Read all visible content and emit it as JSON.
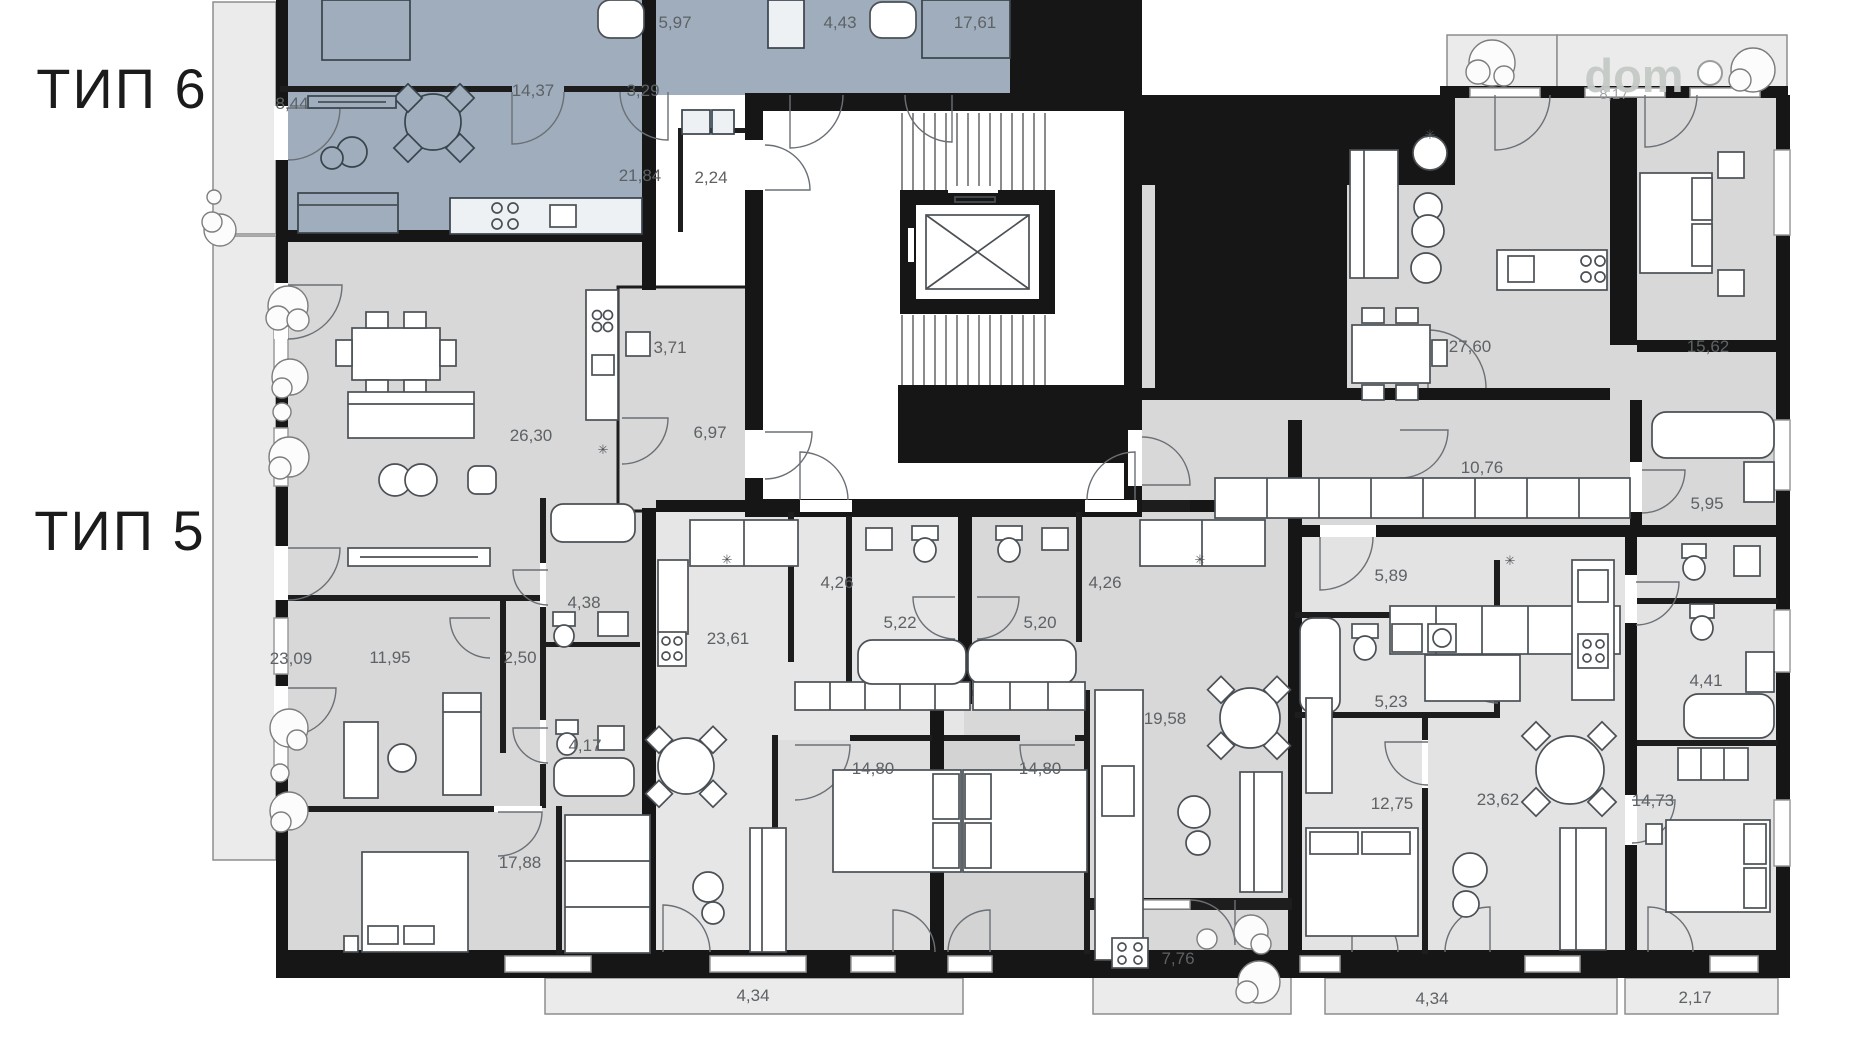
{
  "colors": {
    "type6_fill": "#9fadbc",
    "type6_balcony": "#b6c0ca",
    "room_gray": "#d8d8d8",
    "room_light": "#e6e6e6",
    "balcony_gray": "#ebebeb",
    "wall": "#161616",
    "label_text": "#5d6266",
    "title_text": "#1b1b1b",
    "watermark_gray": "#c6cac6"
  },
  "titles": {
    "type6": "ТИП 6",
    "type5": "ТИП 5"
  },
  "watermark": {
    "brand": "dom",
    "obscured_area": "8,17"
  },
  "symbols": {
    "vent": "✳"
  },
  "apartments": {
    "type6": {
      "name": "Apartment type 6 (highlighted, top left)",
      "areas": {
        "balcony": "8,44",
        "bedroom_a": "14,37",
        "hall_a": "3,29",
        "bathroom": "5,97",
        "hall_b": "4,43",
        "bedroom_b": "17,61",
        "living": "21,84",
        "pantry": "2,24"
      }
    },
    "type5_left": {
      "name": "Apartment type 5 (left)",
      "areas": {
        "balcony": "23,09",
        "living": "26,30",
        "kitchen": "3,71",
        "hall_a": "6,97",
        "bedroom_a": "11,95",
        "hall_b": "2,50",
        "bathroom_a": "4,38",
        "bathroom_b": "4,17",
        "bedroom_b": "17,88"
      }
    },
    "center_left": {
      "name": "Centre-left apartment",
      "areas": {
        "living": "23,61",
        "hall": "4,26",
        "bathroom": "5,22",
        "bedroom": "14,80",
        "balcony": "4,34"
      }
    },
    "center_right": {
      "name": "Centre-right apartment",
      "areas": {
        "living": "19,58",
        "hall": "4,26",
        "bathroom": "5,20",
        "bedroom": "14,80",
        "balcony": "7,76"
      }
    },
    "right_top": {
      "name": "Top-right apartment",
      "areas": {
        "living": "27,60",
        "bedroom": "15,62",
        "hall": "10,76",
        "bathroom": "5,95"
      }
    },
    "right_bottom": {
      "name": "Bottom-right apartment",
      "areas": {
        "hall": "5,89",
        "bathroom_a": "5,23",
        "bedroom_a": "12,75",
        "living": "23,62",
        "bathroom_b": "4,41",
        "bedroom_b": "14,73",
        "balcony_a": "4,34",
        "balcony_b": "2,17"
      }
    }
  }
}
